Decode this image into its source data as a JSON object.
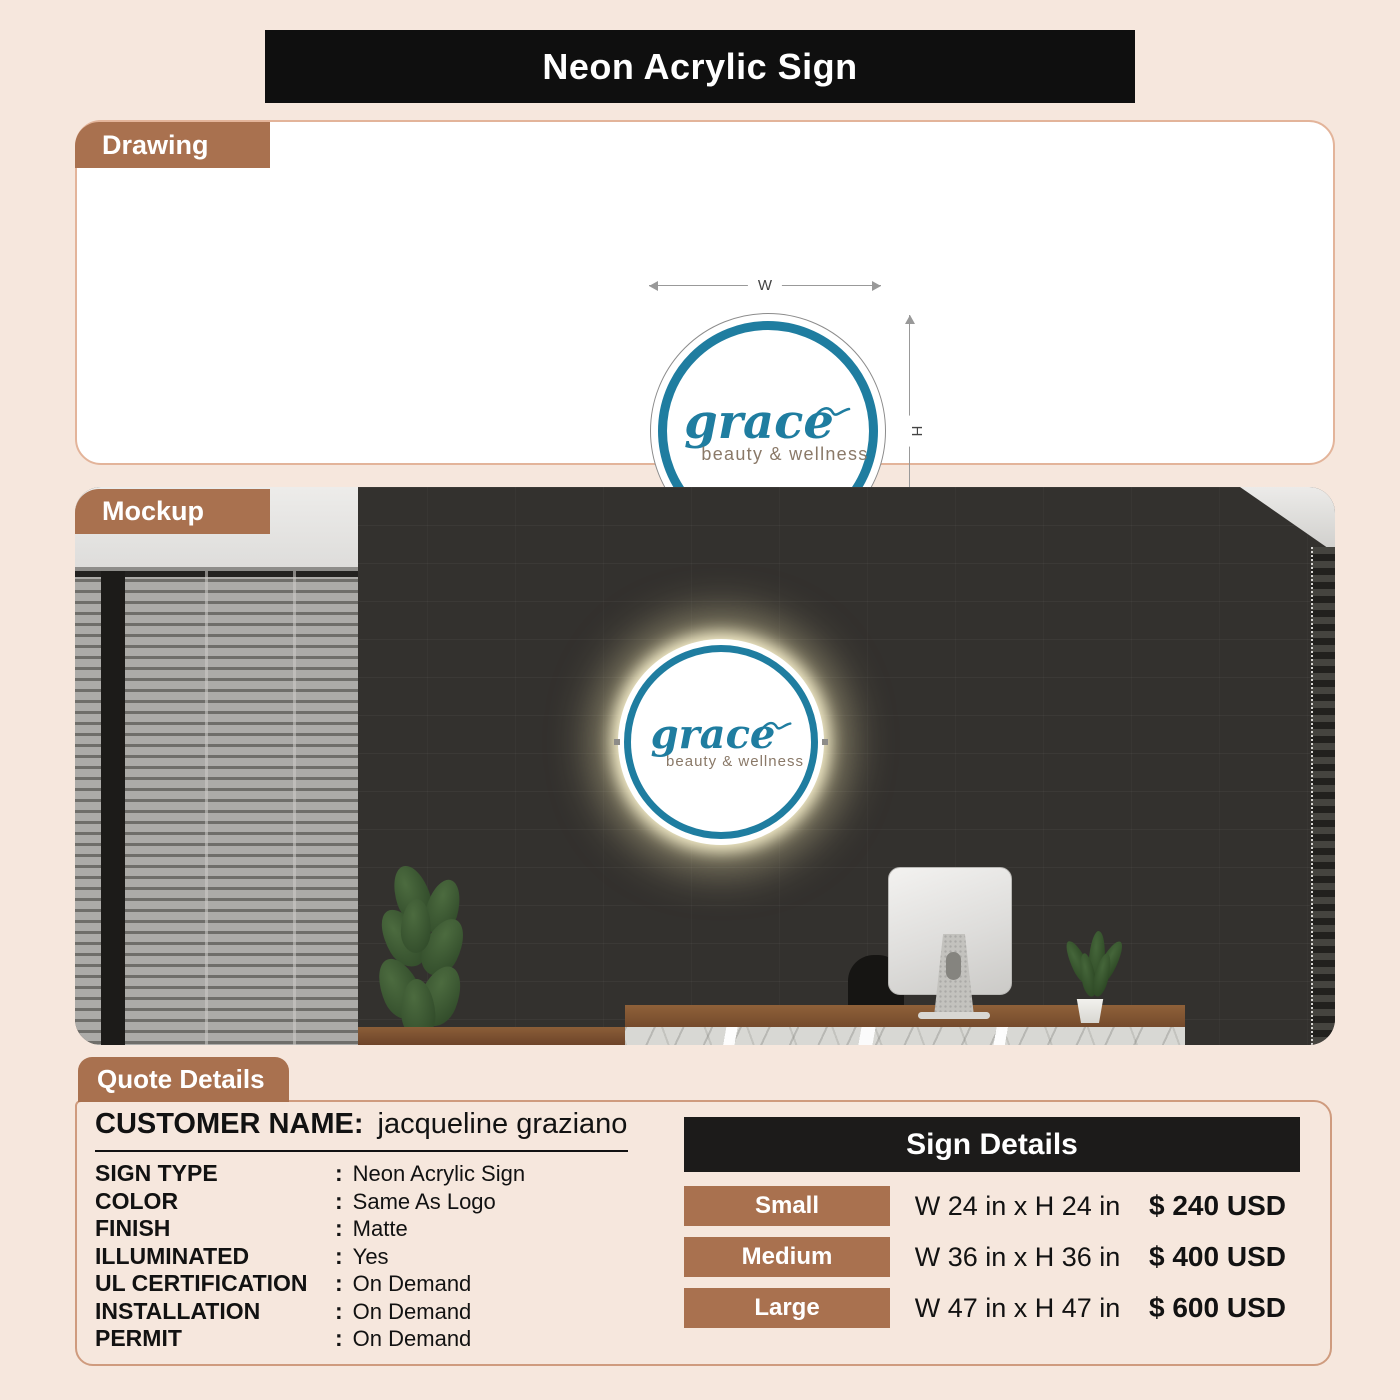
{
  "title": "Neon Acrylic Sign",
  "colors": {
    "page_bg": "#F6E7DD",
    "accent_brown": "#A9714F",
    "bar_black": "#0F0F0F",
    "logo_teal": "#1F7DA0",
    "logo_taupe": "#8A7968"
  },
  "drawing": {
    "tab": "Drawing",
    "width_label": "W",
    "height_label": "H",
    "logo_name": "grace",
    "logo_subtitle": "beauty & wellness"
  },
  "mockup": {
    "tab": "Mockup",
    "sign_name": "grace",
    "sign_subtitle": "beauty & wellness"
  },
  "quote": {
    "tab": "Quote Details",
    "customer_label": "CUSTOMER NAME:",
    "customer_name": "jacqueline graziano",
    "separator": ":",
    "fields": [
      {
        "label": "SIGN TYPE",
        "value": "Neon Acrylic Sign"
      },
      {
        "label": "COLOR",
        "value": "Same As Logo"
      },
      {
        "label": "FINISH",
        "value": "Matte"
      },
      {
        "label": "ILLUMINATED",
        "value": "Yes"
      },
      {
        "label": "UL CERTIFICATION",
        "value": "On Demand"
      },
      {
        "label": "INSTALLATION",
        "value": "On Demand"
      },
      {
        "label": "PERMIT",
        "value": "On Demand"
      }
    ]
  },
  "sign_details": {
    "header": "Sign Details",
    "rows": [
      {
        "size": "Small",
        "dimensions": "W 24 in x H 24 in",
        "price": "$ 240 USD"
      },
      {
        "size": "Medium",
        "dimensions": "W 36 in x H 36 in",
        "price": "$ 400 USD"
      },
      {
        "size": "Large",
        "dimensions": "W 47 in x H 47 in",
        "price": "$ 600 USD"
      }
    ]
  }
}
